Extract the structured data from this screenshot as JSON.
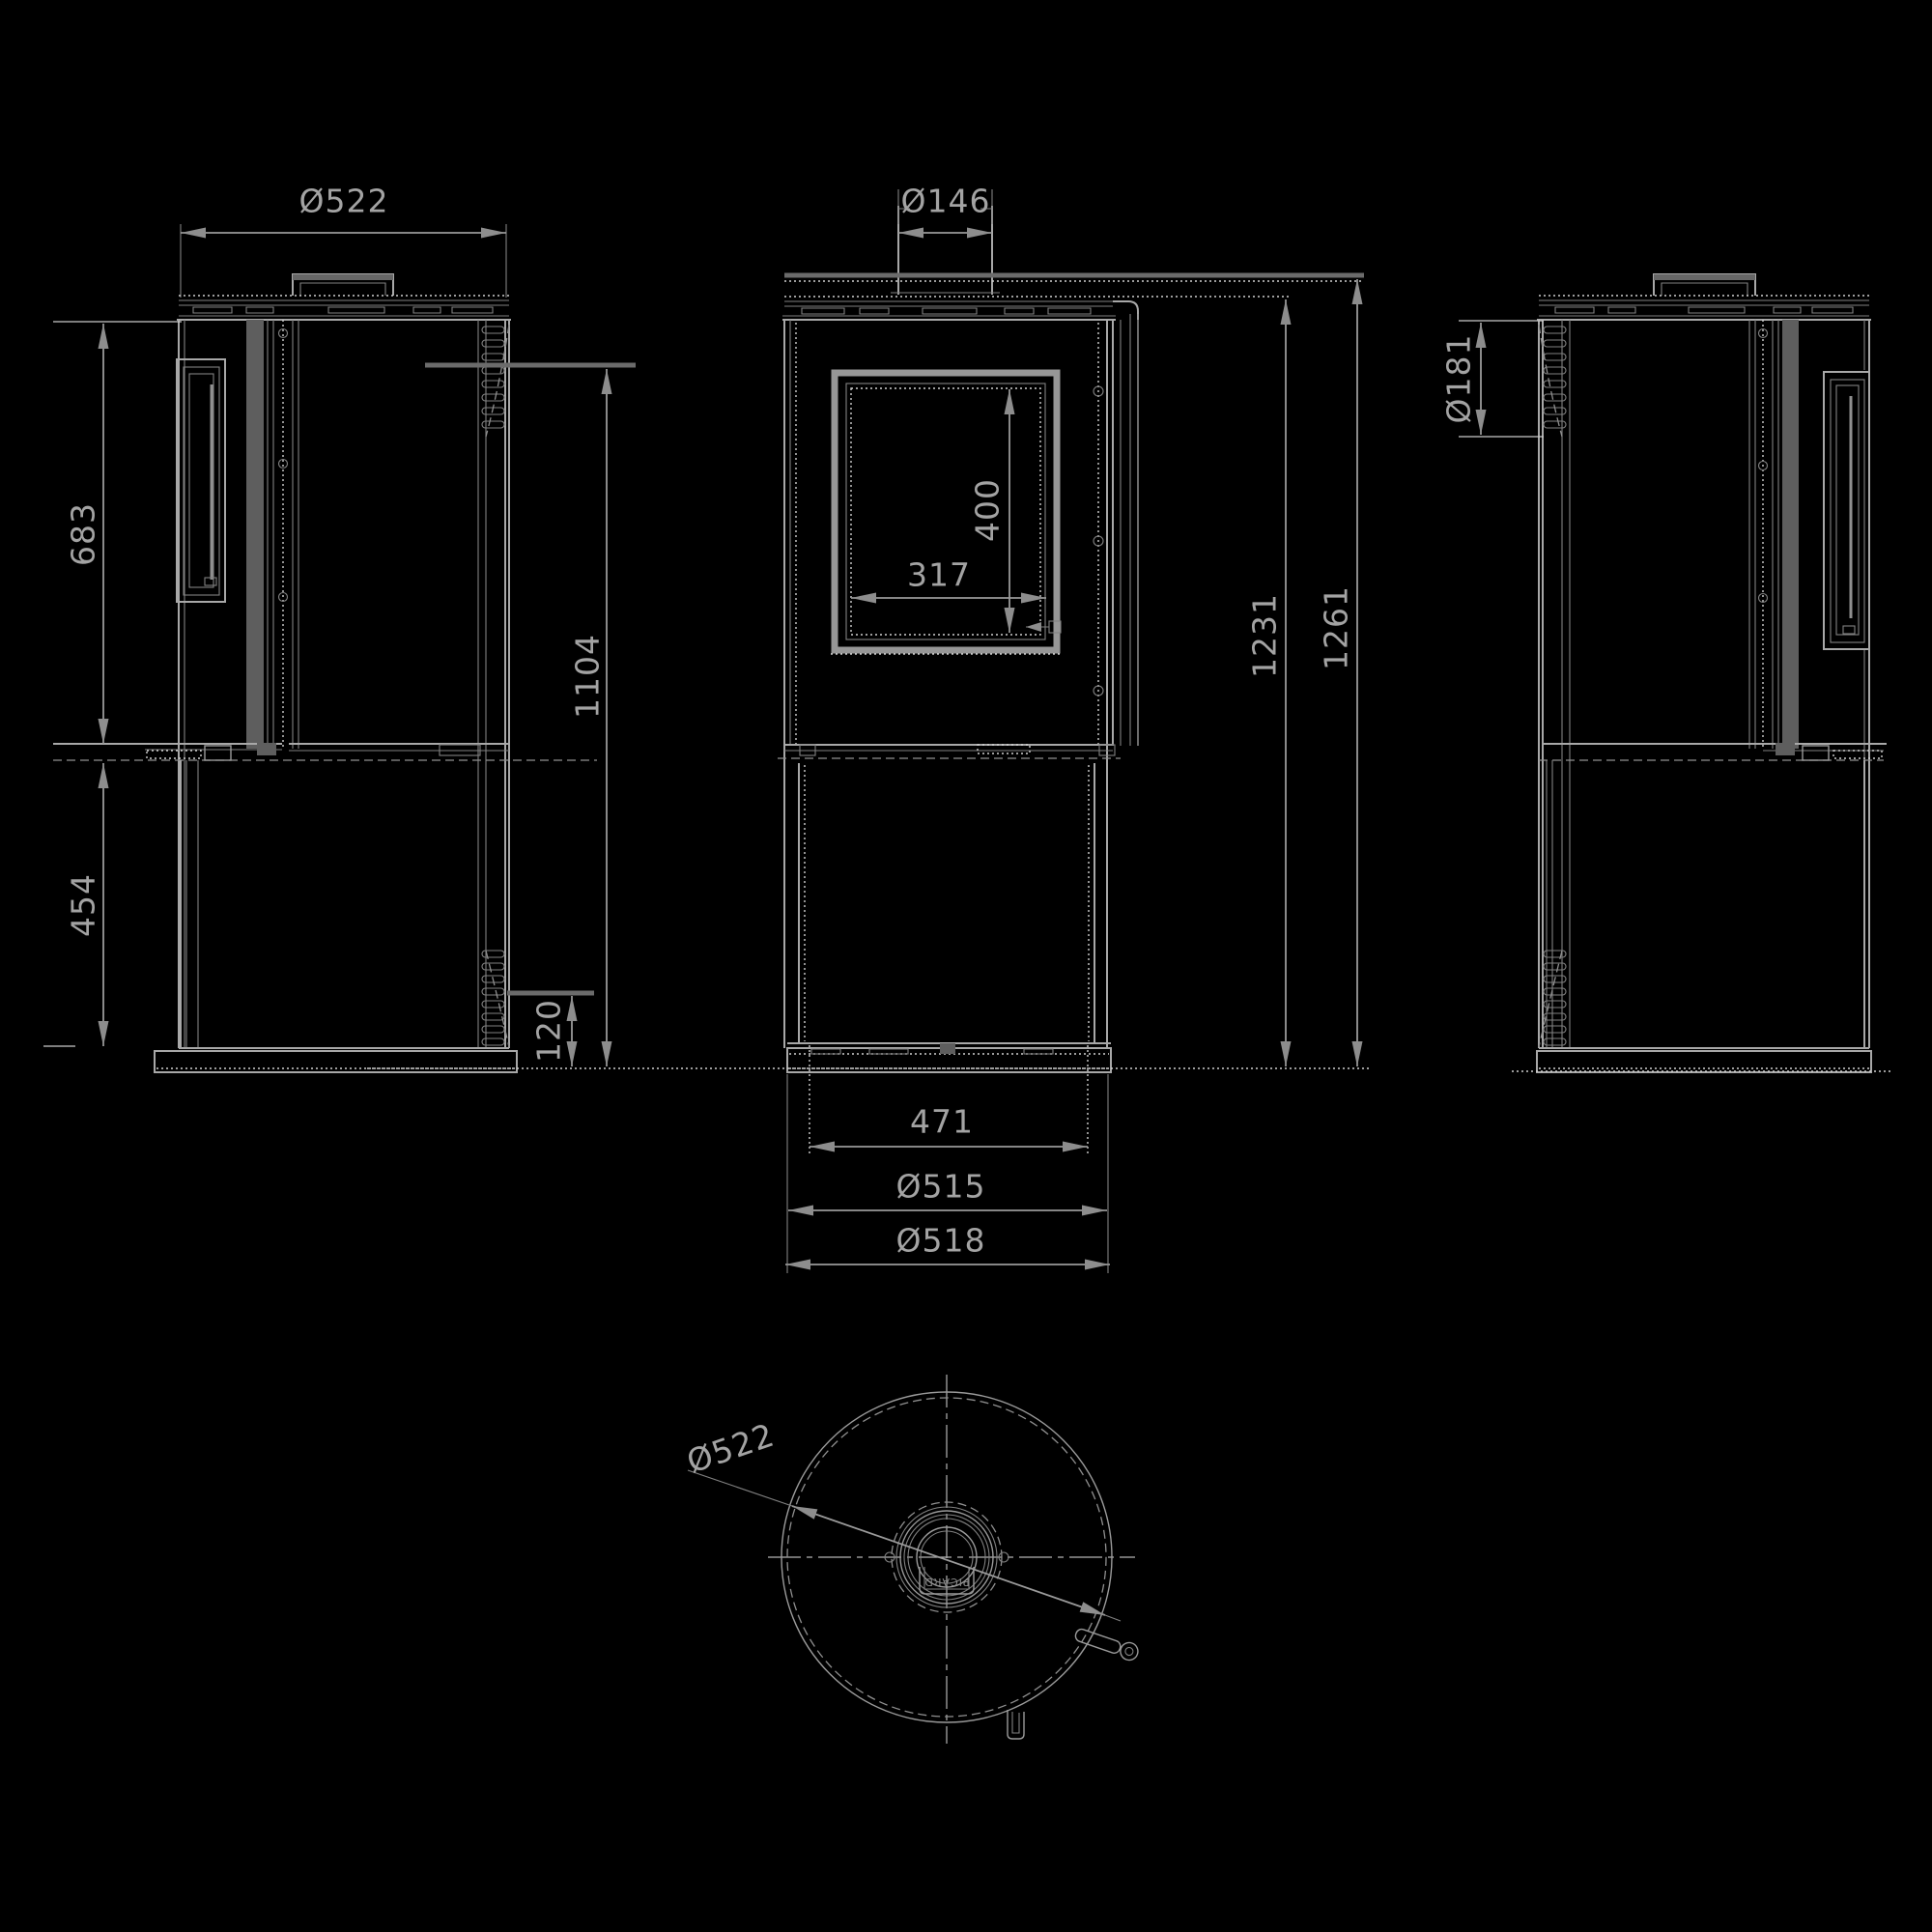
{
  "drawing": {
    "type": "technical-dimension-drawing",
    "subject": "cylindrical wood-burning stove, four orthographic views",
    "colors": {
      "background": "#000000",
      "line": "#a8a8a8",
      "line_bright": "#cfcfcf",
      "line_dim": "#7d7d7d",
      "dimension_text": "#a3a3a3",
      "arrow": "#8d8d8d"
    },
    "views": {
      "left": {
        "name": "left side view",
        "dims": {
          "width": "Ø522",
          "upper_section_height": "683",
          "lower_section_height": "454",
          "overall_height": "1104",
          "base_height": "120"
        }
      },
      "front": {
        "name": "front view",
        "dims": {
          "flue_diameter": "Ø146",
          "glass_height": "400",
          "glass_width": "317",
          "height_to_top_plate": "1231",
          "height_overall": "1261",
          "base_inner_width": "471",
          "body_diameter": "Ø515",
          "outer_diameter": "Ø518"
        }
      },
      "right": {
        "name": "right side view",
        "dims": {
          "rear_channel_depth": "Ø181"
        }
      },
      "plan": {
        "name": "top plan view",
        "dims": {
          "diameter": "Ø522"
        },
        "brand_mark": "PICARD"
      }
    }
  }
}
